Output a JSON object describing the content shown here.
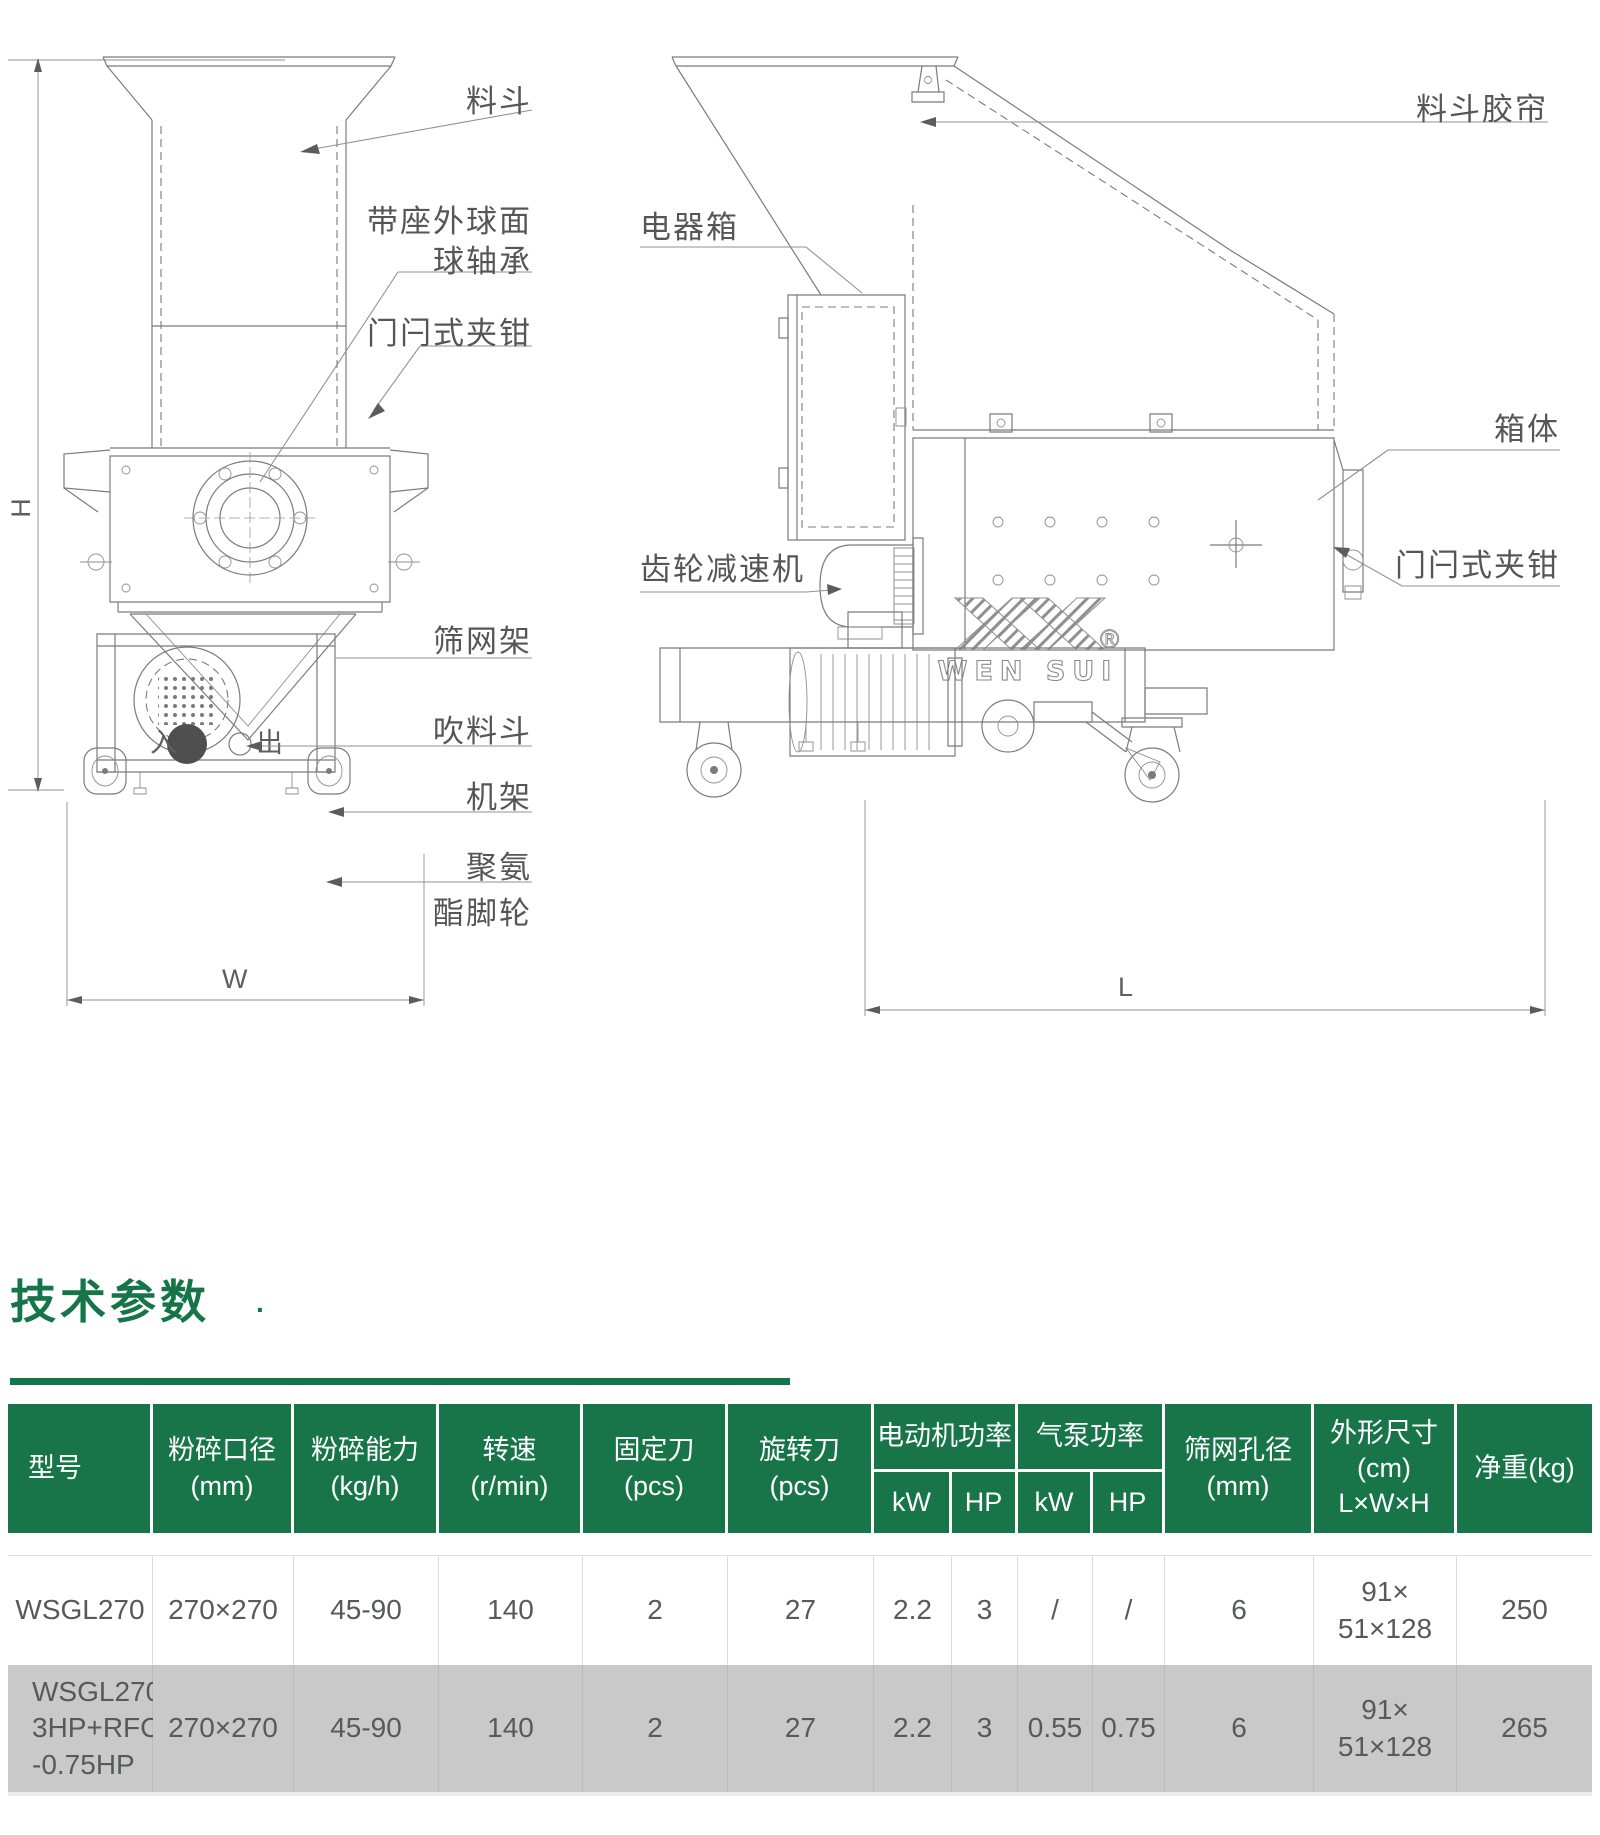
{
  "dims": {
    "h": "H",
    "w": "W",
    "l": "L"
  },
  "front_view": {
    "inlet_mark": "入",
    "outlet_mark": "出",
    "callouts": {
      "hopper": "料斗",
      "bearing_line1": "带座外球面",
      "bearing_line2": "球轴承",
      "latch_clamp": "门闩式夹钳",
      "screen_frame": "筛网架",
      "blow_hopper": "吹料斗",
      "machine_frame": "机架",
      "caster_line1": "聚氨",
      "caster_line2": "酯脚轮"
    }
  },
  "side_view": {
    "logo_text": "WEN SUI",
    "logo_reg": "®",
    "callouts": {
      "hopper_curtain": "料斗胶帘",
      "electric_box": "电器箱",
      "box_body": "箱体",
      "latch_clamp": "门闩式夹钳",
      "gear_reducer": "齿轮减速机"
    }
  },
  "section": {
    "title": "技术参数",
    "dot": "."
  },
  "table": {
    "columns": {
      "model": "型号",
      "caliber": "粉碎口径\n(mm)",
      "capacity": "粉碎能力\n(kg/h)",
      "speed": "转速\n(r/min)",
      "fixed_blade": "固定刀\n(pcs)",
      "rotary_blade": "旋转刀\n(pcs)",
      "motor_power": "电动机功率",
      "pump_power": "气泵功率",
      "kw": "kW",
      "hp": "HP",
      "screen_aperture": "筛网孔径\n(mm)",
      "dimensions": "外形尺寸\n(cm)\nL×W×H",
      "net_weight": "净重(kg)"
    },
    "rows": [
      {
        "model": "WSGL270",
        "caliber": "270×270",
        "capacity": "45-90",
        "speed": "140",
        "fixed_blade": "2",
        "rotary_blade": "27",
        "motor_kw": "2.2",
        "motor_hp": "3",
        "pump_kw": "/",
        "pump_hp": "/",
        "screen_aperture": "6",
        "dimensions": "91×\n51×128",
        "net_weight": "250"
      },
      {
        "model": "WSGL270-\n3HP+RFC\n-0.75HP",
        "caliber": "270×270",
        "capacity": "45-90",
        "speed": "140",
        "fixed_blade": "2",
        "rotary_blade": "27",
        "motor_kw": "2.2",
        "motor_hp": "3",
        "pump_kw": "0.55",
        "pump_hp": "0.75",
        "screen_aperture": "6",
        "dimensions": "91×\n51×128",
        "net_weight": "265"
      }
    ]
  }
}
